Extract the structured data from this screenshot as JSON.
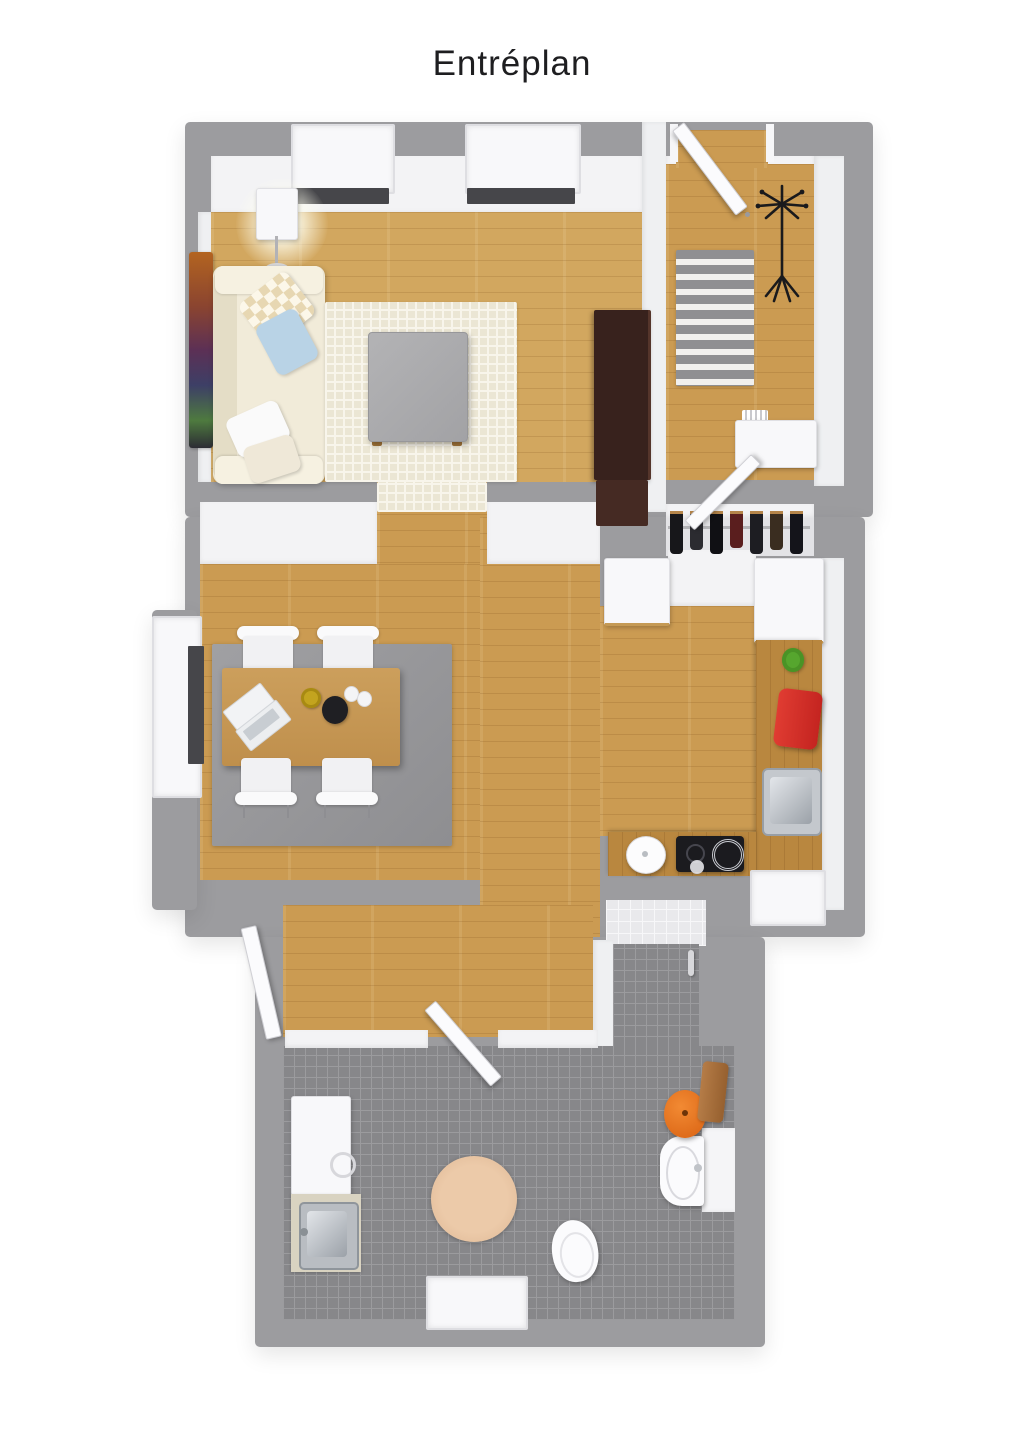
{
  "title": "Entréplan",
  "colors": {
    "background": "#ffffff",
    "outer_wall": "#9c9c9f",
    "inner_wall": "#f3f3f5",
    "wood_floor": "#cb9b52",
    "wood_floor_light": "#d2a75f",
    "wood_counter": "#b9873f",
    "bathroom_tile": "#87878a",
    "tile_grout": "#9b9b9e",
    "cream_rug": "#ebe6d4",
    "gray_rug": "#98989b",
    "striped_rug_gray": "#8f8f92",
    "sofa_cream": "#f1ebd9",
    "espresso_cabinet": "#38221d",
    "coffee_table_gray": "#acacae",
    "window_sill_dark": "#46464a",
    "accent_red_breadbox": "#d32f28",
    "accent_orange_stool": "#e8751f",
    "accent_green_pot": "#56a62e",
    "accent_yellow_bowl": "#c3a41f",
    "accent_blue_pillow": "#b9d3e6",
    "cooktop_black": "#1b1b1f",
    "towel_brown": "#a9713f",
    "round_rug_beige": "#e2bd9e",
    "steel": "#bdc1c6"
  },
  "floor_plan": {
    "type": "3d-top-down-floor-plan",
    "rooms": [
      {
        "id": "living-room",
        "objects": [
          "window",
          "window",
          "floor-lamp",
          "wall-art",
          "sofa",
          "checkered-pillow",
          "blue-pillow",
          "white-pillows",
          "waffle-rug",
          "coffee-table",
          "espresso-cabinet"
        ]
      },
      {
        "id": "entry-hall",
        "objects": [
          "entrance-door",
          "striped-runner-rug",
          "coat-rack",
          "shoe-bench"
        ]
      },
      {
        "id": "closet",
        "objects": [
          "closet-door",
          "clothes-rail",
          "hanging-clothes"
        ]
      },
      {
        "id": "dining-room",
        "objects": [
          "window",
          "gray-rug",
          "dining-table",
          "laptop",
          "yellow-bowl",
          "black-kettle",
          "cups",
          "chair",
          "chair",
          "chair",
          "chair"
        ]
      },
      {
        "id": "kitchen",
        "objects": [
          "tall-cabinet",
          "tall-cabinet",
          "wood-counter",
          "green-utensil-pot",
          "red-breadbox",
          "kitchen-sink",
          "white-pot",
          "cooktop",
          "window"
        ]
      },
      {
        "id": "hallway",
        "objects": [
          "side-door",
          "bathroom-door"
        ]
      },
      {
        "id": "bathroom",
        "objects": [
          "shower",
          "shower-handle",
          "round-rug",
          "toilet",
          "wall-sink",
          "orange-stool",
          "brown-towel",
          "washing-machine",
          "laundry-counter",
          "laundry-sink",
          "window"
        ]
      }
    ]
  }
}
